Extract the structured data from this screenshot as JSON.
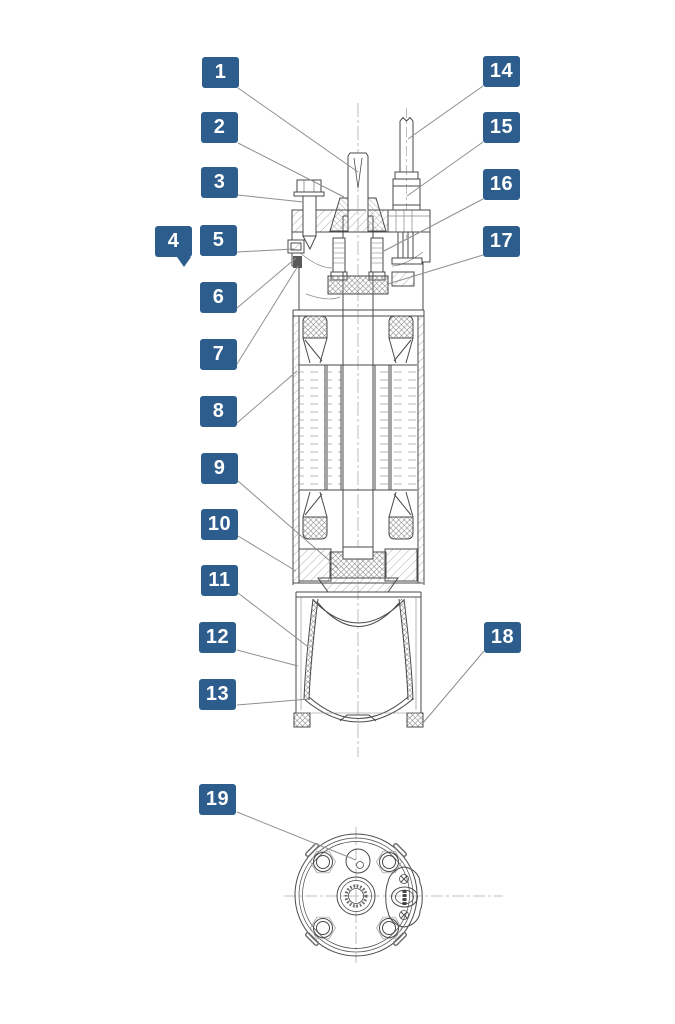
{
  "figure": {
    "accent_color": "#2d5d8c",
    "leader_color": "#8f8f8f",
    "line_color": "#4a4a4a",
    "background": "#ffffff",
    "views": [
      "side-cross-section",
      "bottom-view"
    ],
    "callouts": [
      {
        "number": "1",
        "x": 202,
        "y": 57,
        "leader": [
          238,
          88,
          358,
          172
        ]
      },
      {
        "number": "2",
        "x": 201,
        "y": 112,
        "leader": [
          238,
          143,
          344,
          197
        ]
      },
      {
        "number": "3",
        "x": 201,
        "y": 167,
        "leader": [
          238,
          195,
          303,
          202
        ]
      },
      {
        "number": "4",
        "x": 155,
        "y": 226,
        "tail": true,
        "leader": null
      },
      {
        "number": "5",
        "x": 200,
        "y": 225,
        "leader": [
          237,
          252,
          294,
          249
        ]
      },
      {
        "number": "6",
        "x": 200,
        "y": 282,
        "leader": [
          237,
          308,
          296,
          258
        ]
      },
      {
        "number": "7",
        "x": 200,
        "y": 339,
        "leader": [
          237,
          364,
          298,
          266
        ]
      },
      {
        "number": "8",
        "x": 200,
        "y": 396,
        "leader": [
          237,
          423,
          297,
          371
        ]
      },
      {
        "number": "9",
        "x": 201,
        "y": 453,
        "leader": [
          238,
          481,
          338,
          568
        ]
      },
      {
        "number": "10",
        "x": 201,
        "y": 509,
        "leader": [
          238,
          536,
          296,
          571
        ]
      },
      {
        "number": "11",
        "x": 201,
        "y": 565,
        "leader": [
          238,
          593,
          307,
          646
        ]
      },
      {
        "number": "12",
        "x": 199,
        "y": 622,
        "leader": [
          237,
          650,
          298,
          666
        ]
      },
      {
        "number": "13",
        "x": 199,
        "y": 679,
        "leader": [
          237,
          705,
          309,
          699
        ]
      },
      {
        "number": "14",
        "x": 483,
        "y": 56,
        "leader": [
          483,
          86,
          408,
          139
        ]
      },
      {
        "number": "15",
        "x": 483,
        "y": 112,
        "leader": [
          483,
          142,
          407,
          196
        ]
      },
      {
        "number": "16",
        "x": 483,
        "y": 169,
        "leader": [
          483,
          199,
          384,
          251
        ]
      },
      {
        "number": "17",
        "x": 483,
        "y": 226,
        "leader": [
          483,
          255,
          388,
          284
        ]
      },
      {
        "number": "18",
        "x": 484,
        "y": 622,
        "leader": [
          484,
          651,
          423,
          723
        ]
      },
      {
        "number": "19",
        "x": 199,
        "y": 784,
        "leader": [
          237,
          812,
          356,
          860
        ]
      }
    ]
  }
}
